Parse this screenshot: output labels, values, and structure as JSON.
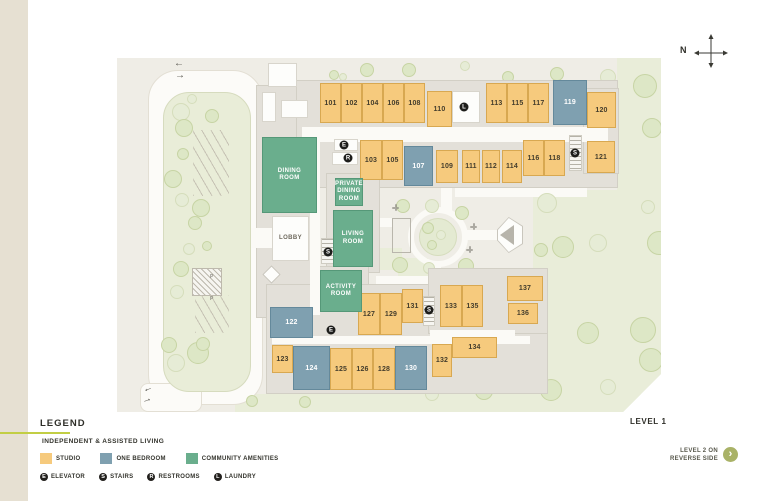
{
  "page": {
    "compass_label": "N",
    "level_label": "LEVEL 1",
    "reverse_note": {
      "line1": "LEVEL 2 ON",
      "line2": "REVERSE SIDE"
    }
  },
  "legend": {
    "title": "LEGEND",
    "subtitle": "INDEPENDENT & ASSISTED LIVING",
    "room_types": [
      {
        "slug": "studio",
        "label": "STUDIO",
        "color": "#F6CA7D"
      },
      {
        "slug": "one_bedroom",
        "label": "ONE BEDROOM",
        "color": "#7FA0B0"
      },
      {
        "slug": "community",
        "label": "COMMUNITY AMENITIES",
        "color": "#6AAE8D"
      }
    ],
    "facility_icons": [
      {
        "symbol": "E",
        "label": "ELEVATOR"
      },
      {
        "symbol": "S",
        "label": "STAIRS"
      },
      {
        "symbol": "R",
        "label": "RESTROOMS"
      },
      {
        "symbol": "L",
        "label": "LAUNDRY"
      }
    ]
  },
  "map": {
    "amenity_rooms": [
      {
        "slug": "dining-room",
        "name": "DINING ROOM"
      },
      {
        "slug": "private-dining-room",
        "name": "PRIVATE DINING ROOM"
      },
      {
        "slug": "living-room",
        "name": "LIVING ROOM"
      },
      {
        "slug": "activity-room",
        "name": "ACTIVITY ROOM"
      },
      {
        "slug": "lobby",
        "name": "LOBBY"
      }
    ],
    "rooms": [
      {
        "number": "101",
        "type": "studio"
      },
      {
        "number": "102",
        "type": "studio"
      },
      {
        "number": "103",
        "type": "studio"
      },
      {
        "number": "104",
        "type": "studio"
      },
      {
        "number": "105",
        "type": "studio"
      },
      {
        "number": "106",
        "type": "studio"
      },
      {
        "number": "107",
        "type": "one_bedroom"
      },
      {
        "number": "108",
        "type": "studio"
      },
      {
        "number": "109",
        "type": "studio"
      },
      {
        "number": "110",
        "type": "studio"
      },
      {
        "number": "111",
        "type": "studio"
      },
      {
        "number": "112",
        "type": "studio"
      },
      {
        "number": "113",
        "type": "studio"
      },
      {
        "number": "114",
        "type": "studio"
      },
      {
        "number": "115",
        "type": "studio"
      },
      {
        "number": "116",
        "type": "studio"
      },
      {
        "number": "117",
        "type": "studio"
      },
      {
        "number": "118",
        "type": "studio"
      },
      {
        "number": "119",
        "type": "one_bedroom"
      },
      {
        "number": "120",
        "type": "studio"
      },
      {
        "number": "121",
        "type": "studio"
      },
      {
        "number": "122",
        "type": "one_bedroom"
      },
      {
        "number": "123",
        "type": "studio"
      },
      {
        "number": "124",
        "type": "one_bedroom"
      },
      {
        "number": "125",
        "type": "studio"
      },
      {
        "number": "126",
        "type": "studio"
      },
      {
        "number": "127",
        "type": "studio"
      },
      {
        "number": "128",
        "type": "studio"
      },
      {
        "number": "129",
        "type": "studio"
      },
      {
        "number": "130",
        "type": "one_bedroom"
      },
      {
        "number": "131",
        "type": "studio"
      },
      {
        "number": "132",
        "type": "studio"
      },
      {
        "number": "133",
        "type": "studio"
      },
      {
        "number": "134",
        "type": "studio"
      },
      {
        "number": "135",
        "type": "studio"
      },
      {
        "number": "136",
        "type": "studio"
      },
      {
        "number": "137",
        "type": "studio"
      }
    ],
    "markers": [
      {
        "id": "elevator-north",
        "symbol": "E"
      },
      {
        "id": "restrooms-north",
        "symbol": "R"
      },
      {
        "id": "laundry-north",
        "symbol": "L"
      },
      {
        "id": "stairs-lobby",
        "symbol": "S"
      },
      {
        "id": "stairs-east",
        "symbol": "S"
      },
      {
        "id": "stairs-south",
        "symbol": "S"
      },
      {
        "id": "elevator-south",
        "symbol": "E"
      }
    ]
  }
}
